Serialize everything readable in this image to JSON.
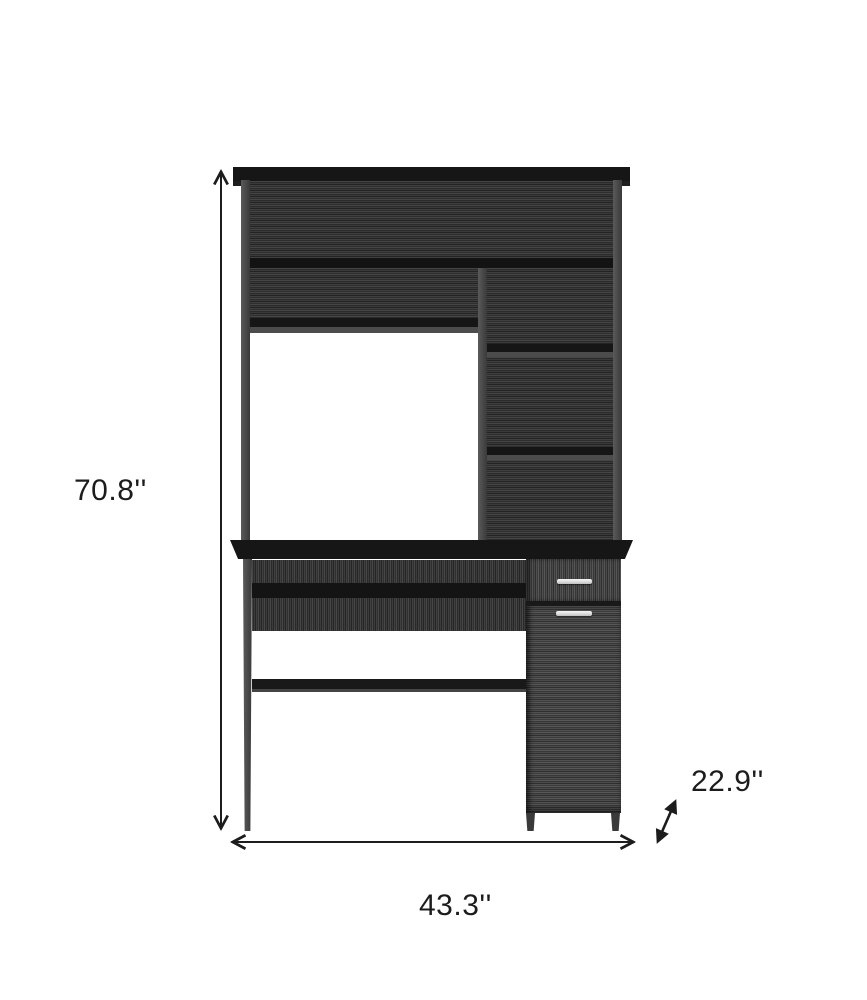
{
  "diagram": {
    "dimensions": {
      "height_label": "70.8''",
      "width_label": "43.3''",
      "depth_label": "22.9''"
    }
  },
  "colors": {
    "background": "#ffffff",
    "board_black": "#161616",
    "wood_dark": "#343434",
    "wood_cabinet": "#464646",
    "frame_gray": "#4c4c4c",
    "handle_silver": "#e9e9e9",
    "annotation": "#1c1c1c"
  }
}
